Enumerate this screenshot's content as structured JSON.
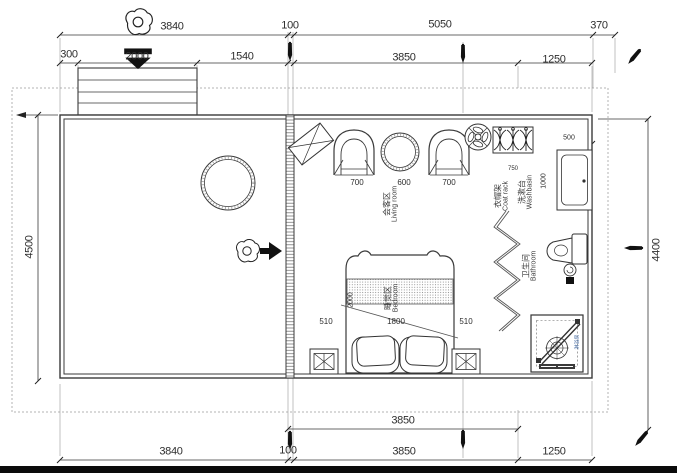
{
  "drawing_type": "floor-plan",
  "dims": {
    "top_outer": [
      "3840",
      "100",
      "5050",
      "370"
    ],
    "top_inner": [
      "300",
      "2000",
      "1540",
      "3850",
      "1250"
    ],
    "left": "4500",
    "right": "4400",
    "bottom_inner": "3850",
    "bottom_outer": [
      "3840",
      "100",
      "3850",
      "1250"
    ],
    "chair_left": "700",
    "table": "600",
    "chair_right": "700",
    "coat_rack": "750",
    "basin_width": "500",
    "basin_depth": "1000",
    "bed_gap_left": "510",
    "bed_width": "1800",
    "bed_gap_right": "510",
    "bed_length": "2000"
  },
  "rooms": {
    "living": {
      "zh": "会客区",
      "en": "Living room"
    },
    "bedroom": {
      "zh": "睡觉区",
      "en": "Bedroom"
    },
    "bathroom": {
      "zh": "卫生间",
      "en": "Bathroom"
    },
    "washbasin": {
      "zh": "洗漱台",
      "en": "Washbasin"
    },
    "coat_rack": {
      "zh": "衣帽架",
      "en": "Coat rack"
    },
    "shower": {
      "zh": "淋浴房"
    }
  },
  "icons": {
    "entry_top": "person-top-view-down-arrow",
    "entry_side": "person-top-view-right-arrow",
    "ceiling_fan": "fan-symbol",
    "marker": "pen-marker"
  },
  "colors": {
    "line": "#3a3a3a",
    "dim_text": "#2e2e2e",
    "boundary": "#b3b3b3",
    "shower_label": "#4a6fa5",
    "arrow": "#111111"
  }
}
